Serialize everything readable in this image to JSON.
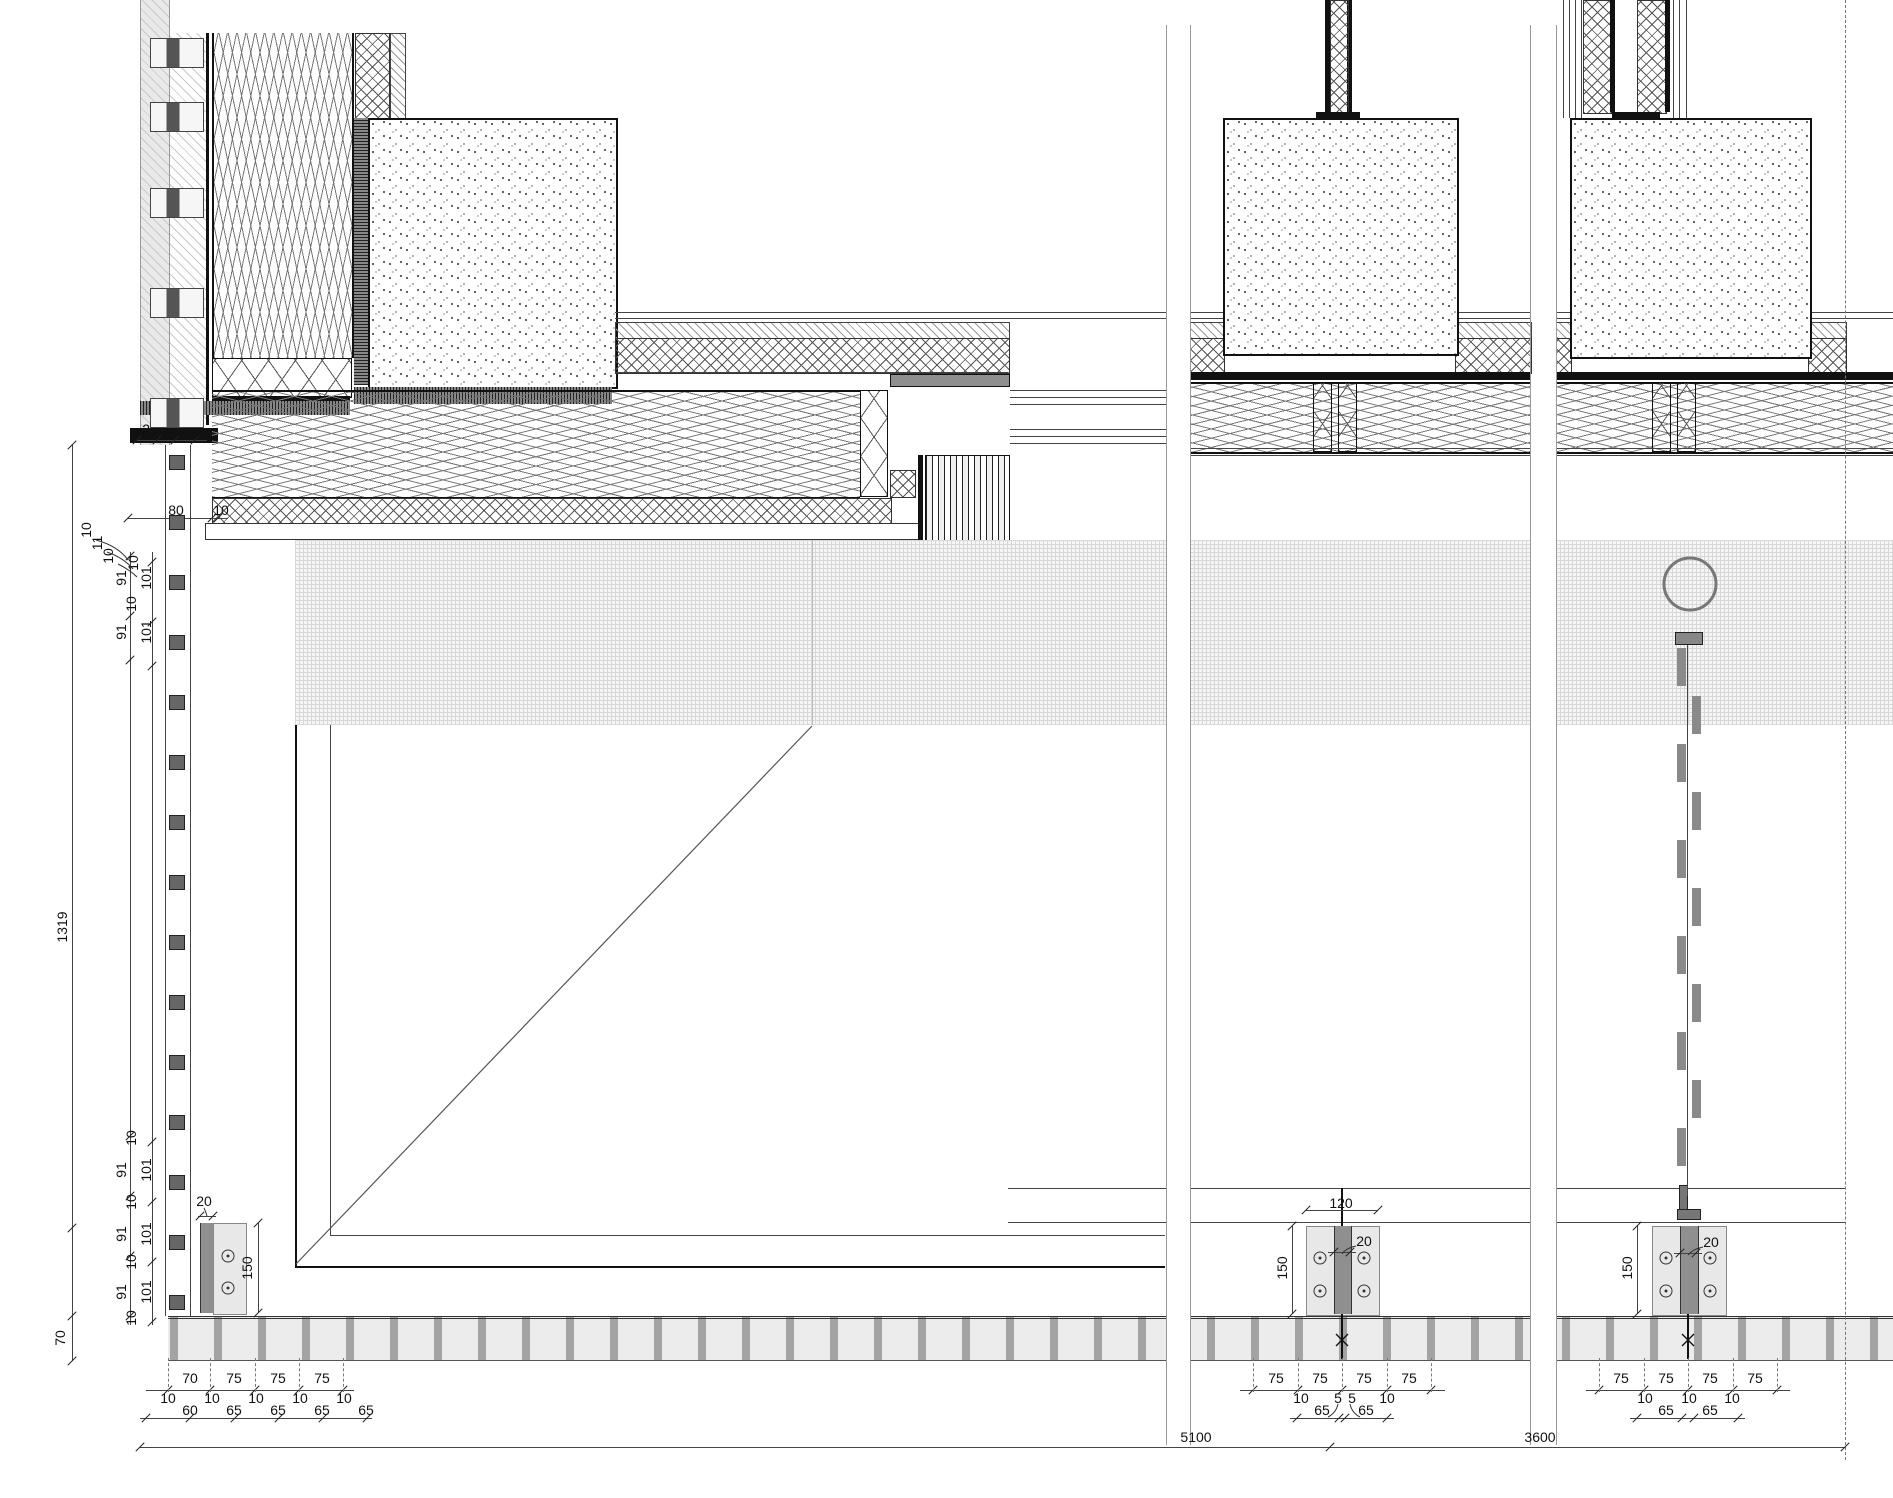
{
  "drawing": {
    "kind": "facade-section-construction-detail",
    "colors": {
      "line": "#333333",
      "panel_gray": "#ececec",
      "bar_gray": "#8f8f8f"
    }
  },
  "dims": {
    "t1": [
      "28",
      "30",
      "33"
    ],
    "t2": [
      "80",
      "10"
    ],
    "cluster": [
      "10",
      "11",
      "10"
    ],
    "ltop": [
      "10",
      "91",
      "101",
      "10",
      "91",
      "101"
    ],
    "overall_v": "1319",
    "lbot": [
      "10",
      "91",
      "101",
      "10",
      "91",
      "101",
      "10",
      "91",
      "101",
      "10"
    ],
    "v70": "70",
    "lb": {
      "d20": "20",
      "d150": "150"
    },
    "bl75": [
      "70",
      "75",
      "75",
      "75"
    ],
    "bl65": [
      "10",
      "60",
      "10",
      "65",
      "10",
      "65",
      "10",
      "65",
      "10",
      "65"
    ],
    "mb": {
      "d120": "120",
      "d20": "20",
      "d150": "150"
    },
    "mb75": [
      "75",
      "75",
      "75",
      "75"
    ],
    "mb65": [
      "10",
      "65",
      "5",
      "5",
      "65",
      "10"
    ],
    "rb": {
      "d20": "20",
      "d150": "150"
    },
    "rb75": [
      "75",
      "75",
      "75",
      "75"
    ],
    "rb65": [
      "10",
      "65",
      "10",
      "65",
      "10"
    ],
    "overall_h": [
      "5100",
      "3600"
    ]
  }
}
